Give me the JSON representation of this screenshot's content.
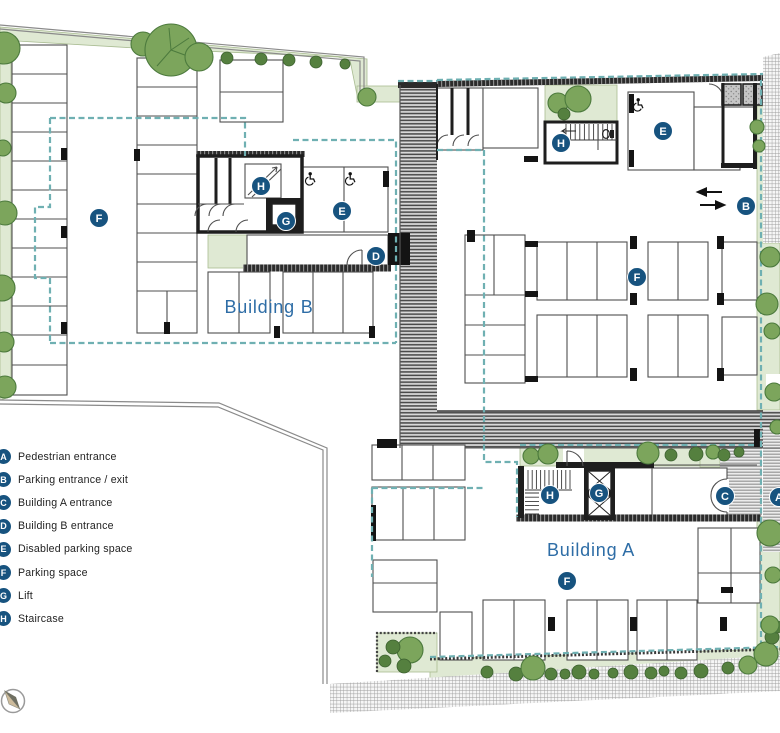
{
  "legend": {
    "items": [
      {
        "letter": "A",
        "label": "Pedestrian entrance"
      },
      {
        "letter": "B",
        "label": "Parking entrance / exit"
      },
      {
        "letter": "C",
        "label": "Building A entrance"
      },
      {
        "letter": "D",
        "label": "Building B entrance"
      },
      {
        "letter": "E",
        "label": "Disabled parking space"
      },
      {
        "letter": "F",
        "label": "Parking space"
      },
      {
        "letter": "G",
        "label": "Lift"
      },
      {
        "letter": "H",
        "label": "Staircase"
      }
    ]
  },
  "plan": {
    "labels": [
      {
        "text": "Building B",
        "x": 269,
        "y": 313
      },
      {
        "text": "Building A",
        "x": 591,
        "y": 556
      }
    ],
    "markers": [
      {
        "letter": "F",
        "x": 99,
        "y": 218
      },
      {
        "letter": "H",
        "x": 261,
        "y": 186
      },
      {
        "letter": "G",
        "x": 286,
        "y": 221
      },
      {
        "letter": "E",
        "x": 342,
        "y": 211
      },
      {
        "letter": "D",
        "x": 376,
        "y": 256
      },
      {
        "letter": "H",
        "x": 561,
        "y": 143
      },
      {
        "letter": "E",
        "x": 663,
        "y": 131
      },
      {
        "letter": "B",
        "x": 746,
        "y": 206
      },
      {
        "letter": "F",
        "x": 637,
        "y": 277
      },
      {
        "letter": "H",
        "x": 550,
        "y": 495
      },
      {
        "letter": "G",
        "x": 599,
        "y": 493
      },
      {
        "letter": "C",
        "x": 725,
        "y": 496
      },
      {
        "letter": "A",
        "x": 779,
        "y": 497
      },
      {
        "letter": "F",
        "x": 567,
        "y": 581
      }
    ]
  },
  "icons": {
    "compass": "compass-north",
    "wheelchair": "disabled-parking",
    "entry_arrows": "two-way-arrows"
  },
  "colors": {
    "marker_bg": "#17537f",
    "marker_text": "#ffffff",
    "building_label": "#2e6da6",
    "teal_dash": "#6fb0b2",
    "landscape_green": "#dfe9d3",
    "tree_green": "#7ca55c"
  }
}
